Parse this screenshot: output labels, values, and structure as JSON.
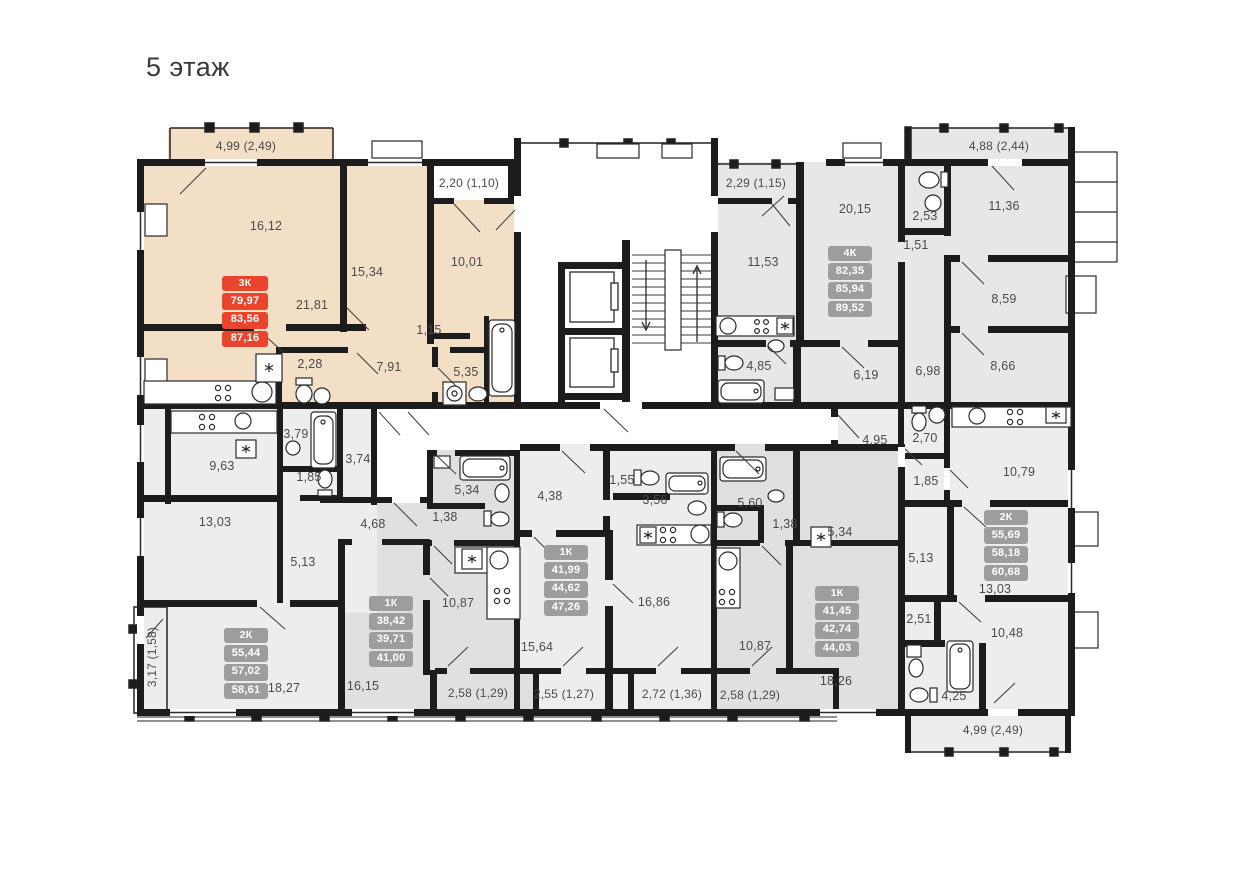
{
  "title": "5 этаж",
  "colors": {
    "wall": "#1c1c1c",
    "highlight_fill": "#f2dfc6",
    "light_fill": "#ededed",
    "dark_fill": "#e0e0e0",
    "mid_fill": "#e7e7e7",
    "badge_red": "#e8452c",
    "badge_gray": "#9d9d9d",
    "label_text": "#4a4a4a"
  },
  "apartments": [
    {
      "id": "apt-3k",
      "badge": {
        "type": "3К",
        "areas": [
          "79,97",
          "83,56",
          "87,16"
        ]
      },
      "rooms": [
        {
          "area": "16,12"
        },
        {
          "area": "15,34"
        },
        {
          "area": "10,01"
        },
        {
          "area": "21,81"
        },
        {
          "area": "1,15"
        },
        {
          "area": "2,28"
        },
        {
          "area": "7,91"
        },
        {
          "area": "5,35"
        }
      ],
      "balconies": [
        {
          "label": "4,99 (2,49)"
        },
        {
          "label": "2,20 (1,10)"
        }
      ]
    },
    {
      "id": "apt-4k",
      "badge": {
        "type": "4К",
        "areas": [
          "82,35",
          "85,94",
          "89,52"
        ]
      },
      "rooms": [
        {
          "area": "20,15"
        },
        {
          "area": "2,53"
        },
        {
          "area": "1,51"
        },
        {
          "area": "11,36"
        },
        {
          "area": "11,53"
        },
        {
          "area": "8,59"
        },
        {
          "area": "8,66"
        },
        {
          "area": "6,19"
        },
        {
          "area": "6,98"
        },
        {
          "area": "4,85"
        }
      ],
      "balconies": [
        {
          "label": "4,88 (2,44)"
        },
        {
          "label": "2,29 (1,15)"
        }
      ]
    },
    {
      "id": "apt-2k-left",
      "badge": {
        "type": "2К",
        "areas": [
          "55,44",
          "57,02",
          "58,61"
        ]
      },
      "rooms": [
        {
          "area": "9,63"
        },
        {
          "area": "3,79"
        },
        {
          "area": "3,74"
        },
        {
          "area": "1,85"
        },
        {
          "area": "13,03"
        },
        {
          "area": "5,13"
        },
        {
          "area": "18,27"
        }
      ],
      "balconies": [
        {
          "label": "3,17 (1,58)"
        }
      ]
    },
    {
      "id": "apt-1k-a",
      "badge": {
        "type": "1К",
        "areas": [
          "38,42",
          "39,71",
          "41,00"
        ]
      },
      "rooms": [
        {
          "area": "4,68"
        },
        {
          "area": "5,34"
        },
        {
          "area": "1,38"
        },
        {
          "area": "10,87"
        },
        {
          "area": "16,15"
        }
      ],
      "balconies": [
        {
          "label": "2,58 (1,29)"
        }
      ]
    },
    {
      "id": "apt-1k-b",
      "badge": {
        "type": "1К",
        "areas": [
          "41,99",
          "44,62",
          "47,26"
        ]
      },
      "rooms": [
        {
          "area": "4,38"
        },
        {
          "area": "1,55"
        },
        {
          "area": "3,56"
        },
        {
          "area": "16,86"
        },
        {
          "area": "15,64"
        }
      ],
      "balconies": [
        {
          "label": "2,55 (1,27)"
        },
        {
          "label": "2,72 (1,36)"
        }
      ]
    },
    {
      "id": "apt-1k-c",
      "badge": {
        "type": "1К",
        "areas": [
          "41,45",
          "42,74",
          "44,03"
        ]
      },
      "rooms": [
        {
          "area": "5,60"
        },
        {
          "area": "1,38"
        },
        {
          "area": "5,34"
        },
        {
          "area": "10,87"
        },
        {
          "area": "18,26"
        }
      ],
      "balconies": [
        {
          "label": "2,58 (1,29)"
        }
      ]
    },
    {
      "id": "apt-2k-right",
      "badge": {
        "type": "2К",
        "areas": [
          "55,69",
          "58,18",
          "60,68"
        ]
      },
      "rooms": [
        {
          "area": "4,95"
        },
        {
          "area": "2,70"
        },
        {
          "area": "1,85"
        },
        {
          "area": "10,79"
        },
        {
          "area": "5,13"
        },
        {
          "area": "13,03"
        },
        {
          "area": "2,51"
        },
        {
          "area": "10,48"
        },
        {
          "area": "4,25"
        }
      ],
      "balconies": [
        {
          "label": "4,99 (2,49)"
        }
      ]
    }
  ]
}
